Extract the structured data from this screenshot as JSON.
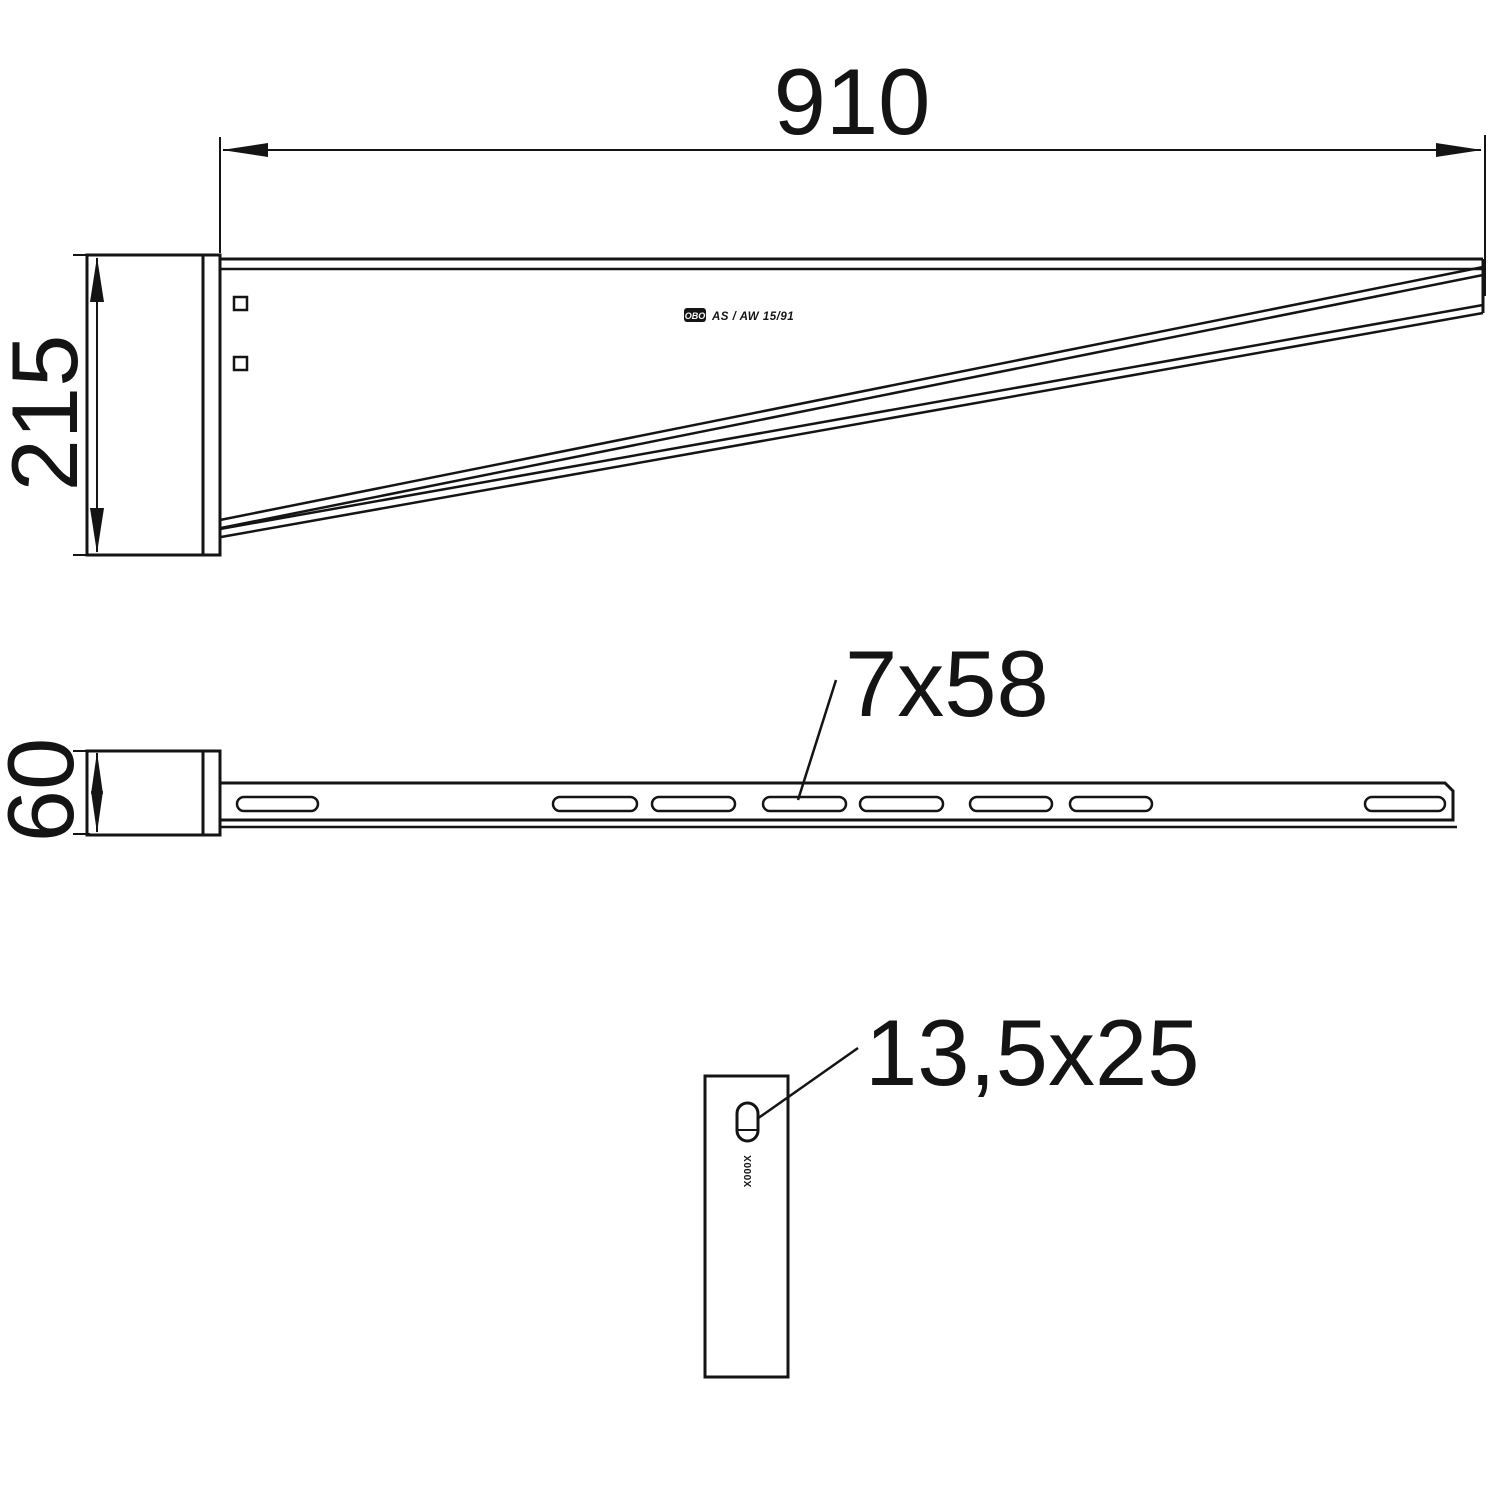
{
  "drawing": {
    "type": "technical-drawing-wall-bracket",
    "colors": {
      "background": "#ffffff",
      "line": "#141414"
    },
    "dimensions": {
      "arm_length": "910",
      "plate_height": "215",
      "plate_width": "60",
      "arm_slot_size": "7x58",
      "plate_slot_size": "13,5x25"
    },
    "part_label": {
      "brand": "OBO",
      "product": "AS / AW 15/91"
    },
    "stamp_marking": "X000X"
  }
}
